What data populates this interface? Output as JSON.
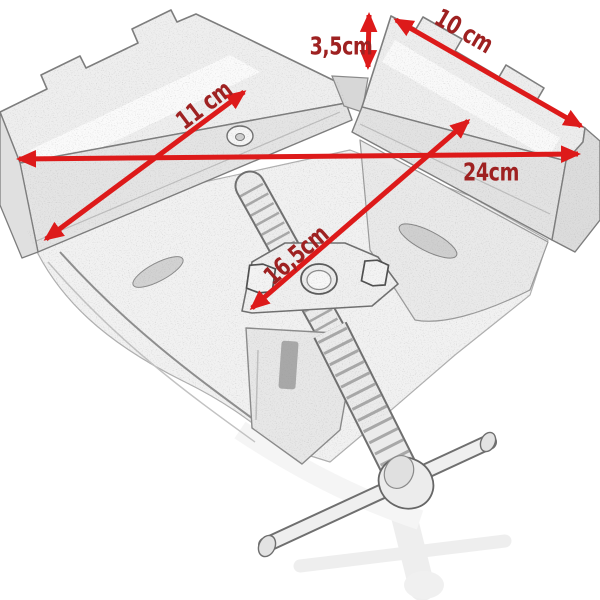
{
  "colors": {
    "arrow": "#dd1a1a",
    "label": "#9e2121"
  },
  "dimensions": [
    {
      "name": "jaw-height",
      "label": "3,5cm"
    },
    {
      "name": "right-jaw-length",
      "label": "10 cm"
    },
    {
      "name": "left-jaw-length",
      "label": "11 cm"
    },
    {
      "name": "overall-width",
      "label": "24cm"
    },
    {
      "name": "diagonal-depth",
      "label": "16,5cm"
    }
  ]
}
